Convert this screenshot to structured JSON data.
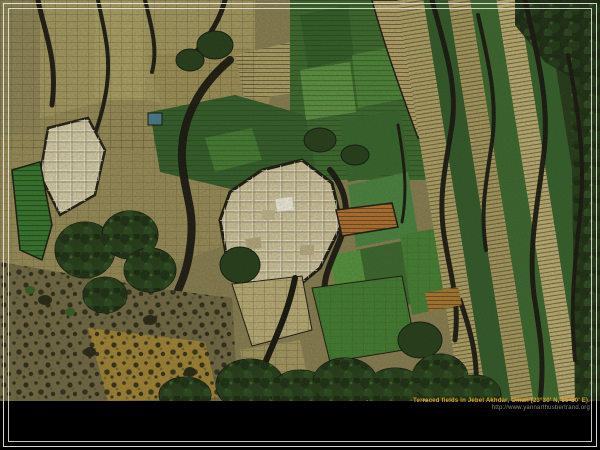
{
  "caption": {
    "title": "Terraced fields in Jebel Akhdar, Oman (23°30' N, 56°50' E).",
    "url": "http://www.yannarthusbertrand.org"
  },
  "colors": {
    "background": "#000000",
    "frame_line": "#e8e6dc",
    "caption_title": "#dca32b",
    "caption_url": "#8d8d85",
    "terrace_pale": "#cfc49c",
    "terrace_tan": "#a89a5e",
    "soil_ochre": "#a8862e",
    "rust_strip": "#b26d2a",
    "green_striped": "#2e7227",
    "field_green_dark": "#2b5524",
    "field_green": "#3c7a2c",
    "ravine_dark": "#12110a"
  }
}
